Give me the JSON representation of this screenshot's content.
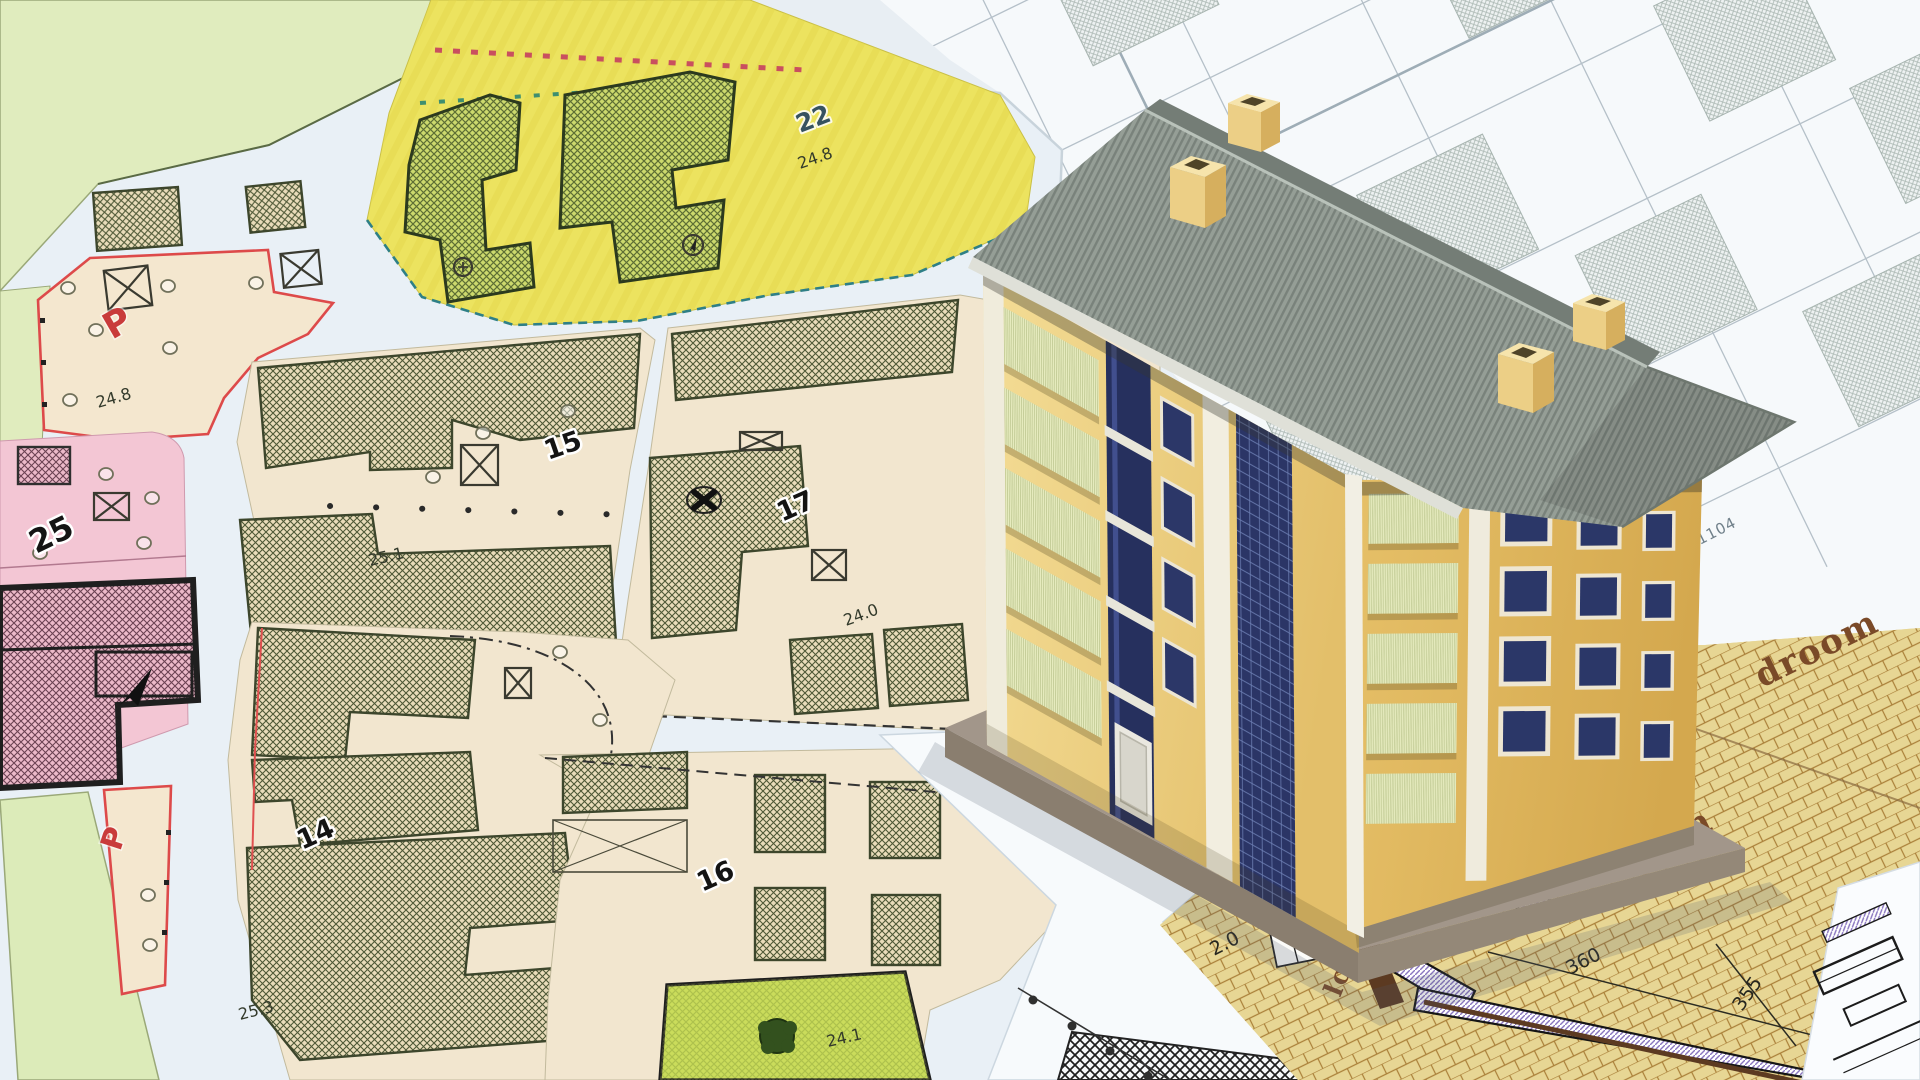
{
  "map": {
    "parcel22": {
      "number": "22",
      "area": "24.8"
    },
    "parking_upper": {
      "label": "P",
      "area": "24.8"
    },
    "parcel25": {
      "number": "25"
    },
    "parcel15": {
      "number": "15",
      "area": "25.1"
    },
    "parcel17": {
      "number": "17",
      "area": "24.0"
    },
    "parcel14": {
      "number": "14",
      "area": "25.3"
    },
    "parcel16": {
      "number": "16",
      "area": "24.1"
    },
    "parking_lower": {
      "label": "P"
    }
  },
  "cadastral": {
    "parcel_number": "1104"
  },
  "floorplan": {
    "bedroom_label_1": "droom",
    "bedroom_label_2": "droom",
    "closet_label": "lose",
    "dim_width": "360",
    "dim_depth": "355",
    "dim_wall": "2.0"
  },
  "colors": {
    "yellow_zone": "#ece35f",
    "tan_parcel": "#f2e6cf",
    "pink_parcel": "#f3c6d4",
    "pale_green": "#dfecbc",
    "bright_green": "#c9dd55",
    "red_boundary": "#dd4a4a",
    "teal_boundary": "#2e7f86",
    "building_wall": "#eecd7e",
    "roof": "#8e978f",
    "balcony": "#e3e8bb",
    "window_glass": "#2b3566",
    "floorplan_paper": "#e7d694",
    "floorplan_text": "#7a4a28"
  }
}
